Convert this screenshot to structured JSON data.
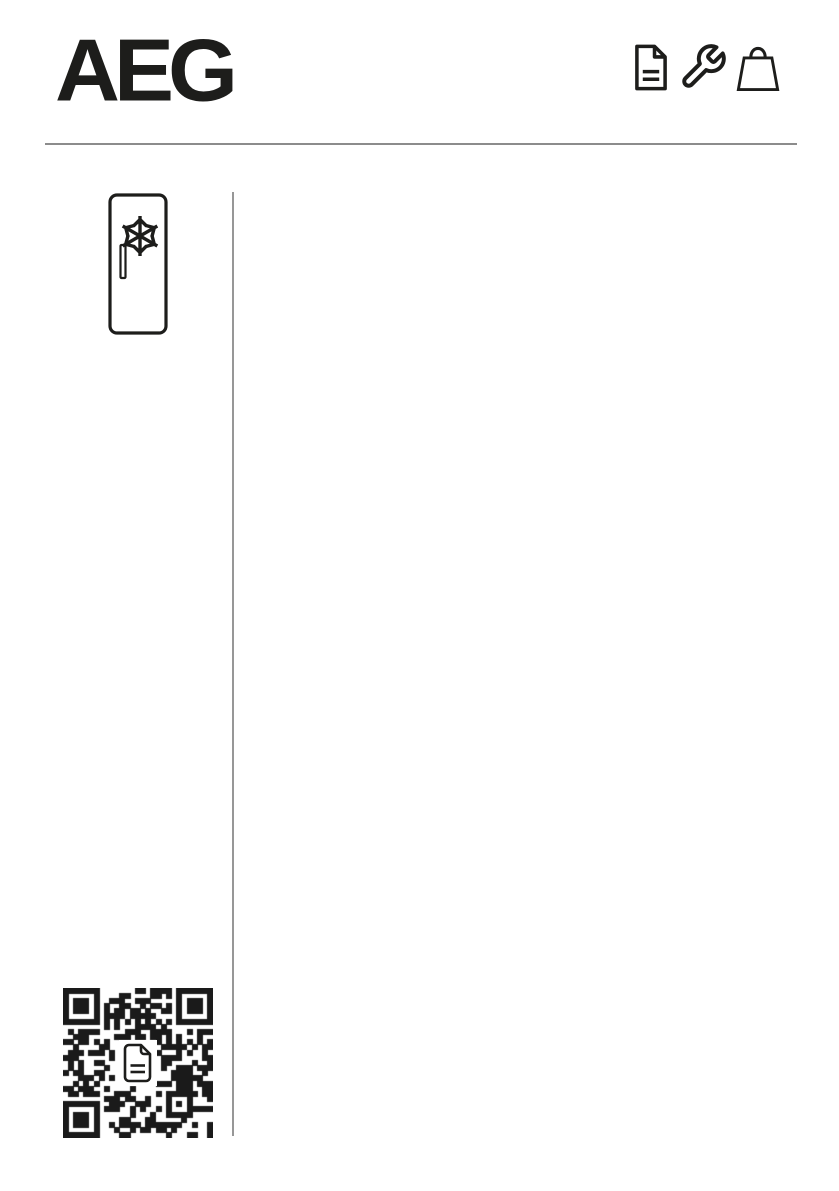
{
  "page": {
    "background_color": "#ffffff",
    "ink_color": "#1d1d1b",
    "rule_color": "#8c8c8c",
    "divider_color": "#979797"
  },
  "header": {
    "logo_text": "AEG",
    "icons": [
      {
        "name": "document-icon"
      },
      {
        "name": "wrench-icon"
      },
      {
        "name": "shopping-bag-icon"
      }
    ]
  },
  "left_column": {
    "appliance_icon": {
      "name": "freezer-icon"
    },
    "qr_code": {
      "name": "qr-code",
      "center_icon": "document-icon"
    }
  }
}
